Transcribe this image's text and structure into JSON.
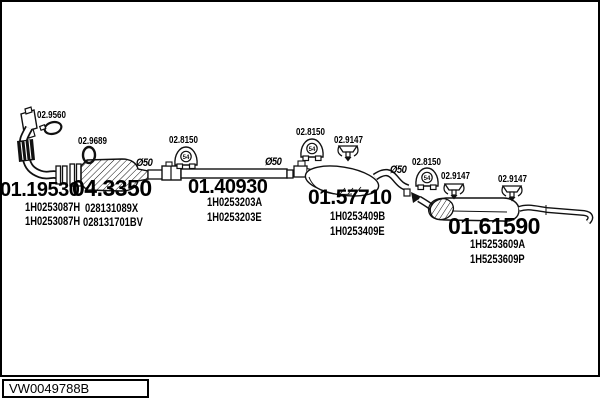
{
  "diagram": {
    "code": "VW0049788B",
    "parts": [
      {
        "number": "01.19530",
        "oem": [
          "1H0253087H",
          "1H0253087H"
        ]
      },
      {
        "number": "04.3350",
        "oem": [
          "028131089X",
          "028131701BV"
        ]
      },
      {
        "number": "01.40930",
        "oem": [
          "1H0253203A",
          "1H0253203E"
        ]
      },
      {
        "number": "01.57710",
        "oem": [
          "1H0253409B",
          "1H0253409E"
        ]
      },
      {
        "number": "01.61590",
        "oem": [
          "1H5253609A",
          "1H5253609P"
        ]
      }
    ],
    "fittings": [
      "02.9560",
      "02.9689",
      "02.8150",
      "02.8150",
      "02.9147",
      "02.8150",
      "02.9147",
      "02.9147"
    ],
    "labels": {
      "diameter": "Ø50",
      "hanger_size": "54"
    }
  }
}
